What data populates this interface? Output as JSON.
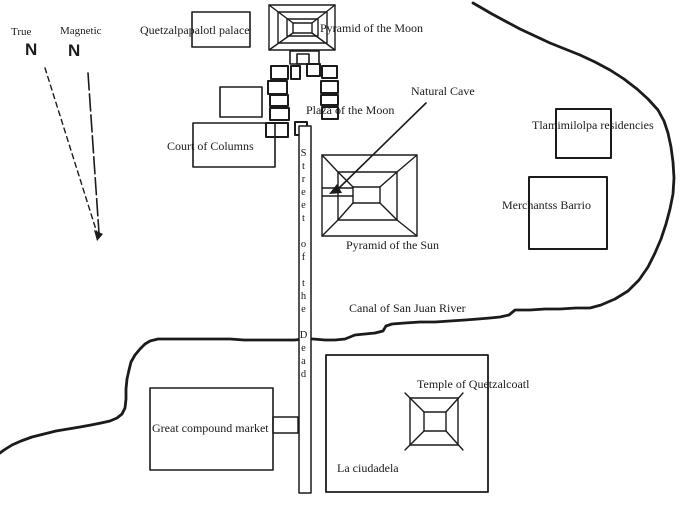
{
  "map": {
    "compass": {
      "true_label": "True",
      "true_n": "N",
      "magnetic_label": "Magnetic",
      "magnetic_n": "N"
    },
    "labels": {
      "palace": "Quetzalpapalotl palace",
      "pyramid_moon": "Pyramid of the Moon",
      "plaza_moon": "Plaza of the Moon",
      "court_columns": "Court of Columns",
      "natural_cave": "Natural Cave",
      "pyramid_sun": "Pyramid of the Sun",
      "tlamimilolpa": "Tlamimilolpa residencies",
      "merchants_barrio": "Merchantss Barrio",
      "street_of_the_dead": "Street of the Dead",
      "canal": "Canal of San Juan River",
      "market": "Great compound market",
      "temple_quetzalcoatl": "Temple of Quetzalcoatl",
      "ciudadela": "La ciudadela"
    },
    "colors": {
      "ink": "#1b1b1b",
      "background": "#ffffff"
    }
  }
}
